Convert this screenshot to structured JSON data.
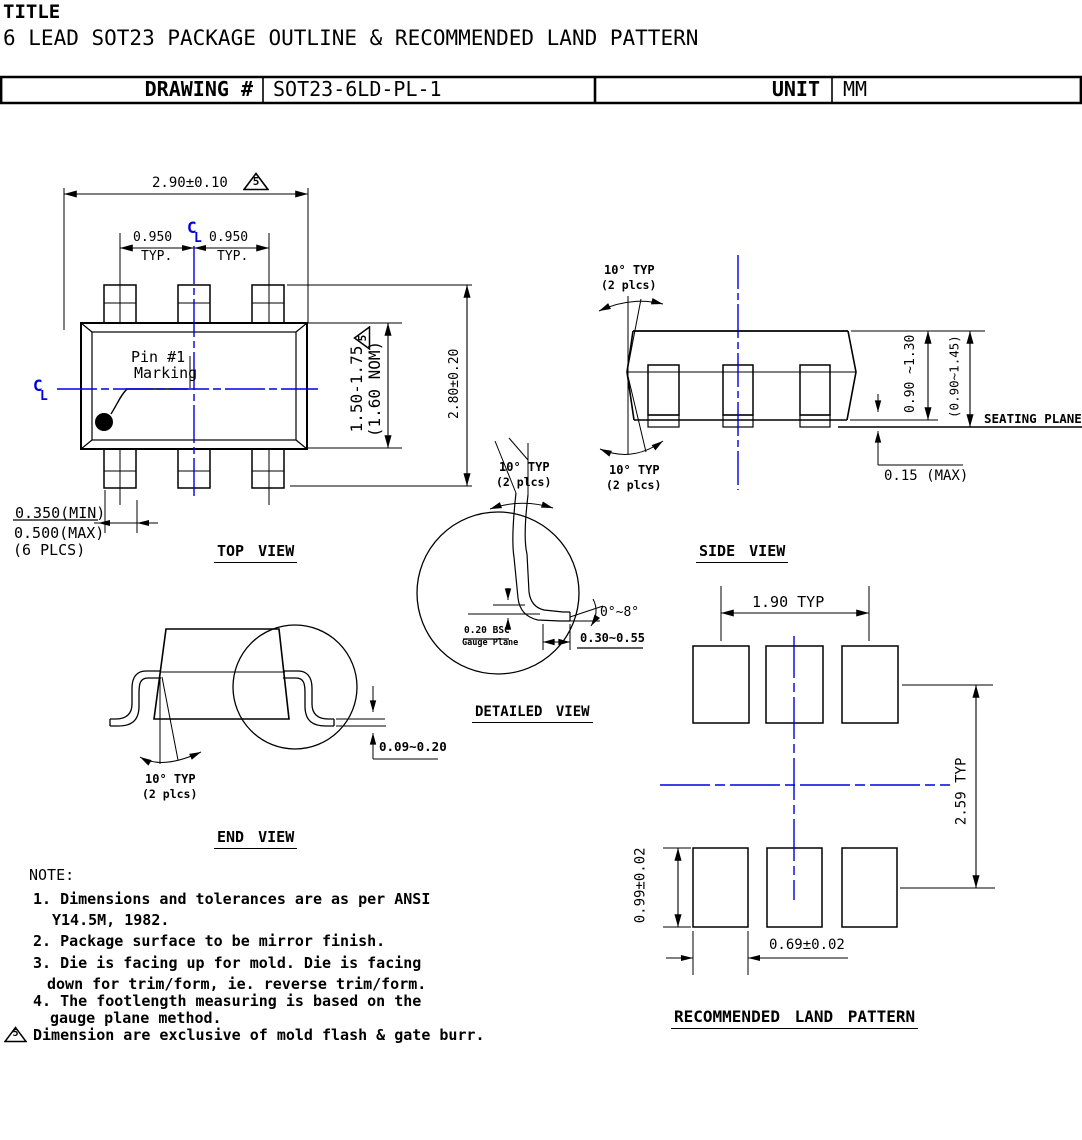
{
  "title_block": {
    "label": "TITLE",
    "subtitle": "6 LEAD SOT23 PACKAGE OUTLINE & RECOMMENDED LAND PATTERN",
    "drawing_label": "DRAWING #",
    "drawing_number": "SOT23-6LD-PL-1",
    "unit_label": "UNIT",
    "unit_value": "MM"
  },
  "colors": {
    "ink": "#000000",
    "centerline": "#0000e0"
  },
  "top_view": {
    "caption": "TOP VIEW",
    "width_dim": "2.90±0.10",
    "pitch_left": "0.950",
    "pitch_right": "0.950",
    "typ_left": "TYP.",
    "typ_right": "TYP.",
    "pin1_line1": "Pin #1",
    "pin1_line2": "Marking",
    "body_range": "1.50-1.75",
    "body_nom": "(1.60 NOM)",
    "overall_dim": "2.80±0.20",
    "lead_w_min": "0.350(MIN)",
    "lead_w_max": "0.500(MAX)",
    "lead_w_plcs": "(6 PLCS)"
  },
  "side_view": {
    "caption": "SIDE VIEW",
    "angle_top": "10° TYP",
    "angle_top_plcs": "(2 plcs)",
    "angle_bottom": "10° TYP",
    "angle_bottom_plcs": "(2 plcs)",
    "body_height": "0.90 ~1.30",
    "total_height": "(0.90~1.45)",
    "seating_plane": "SEATING PLANE",
    "standoff": "0.15 (MAX)"
  },
  "detailed_view": {
    "caption": "DETAILED VIEW",
    "angle": "10° TYP",
    "angle_plcs": "(2 plcs)",
    "lead_angle": "0°~8°",
    "gauge_dim": "0.20 BSC",
    "gauge_label": "Gauge Plane",
    "foot_length": "0.30~0.55"
  },
  "end_view": {
    "caption": "END VIEW",
    "angle": "10° TYP",
    "angle_plcs": "(2 plcs)",
    "lead_thickness": "0.09~0.20"
  },
  "land_pattern": {
    "caption": "RECOMMENDED LAND PATTERN",
    "pitch": "1.90 TYP",
    "row_span": "2.59 TYP",
    "pad_height": "0.99±0.02",
    "pad_width": "0.69±0.02"
  },
  "notes": {
    "heading": "NOTE:",
    "lines": [
      "1. Dimensions and tolerances are as per ANSI",
      "Y14.5M, 1982.",
      "2. Package surface to be mirror finish.",
      "3. Die is facing up for mold. Die is facing",
      "down for trim/form, ie. reverse trim/form.",
      "4. The footlength measuring is based on the",
      "gauge plane method.",
      "Dimension are exclusive of mold flash & gate burr."
    ]
  },
  "symbols": {
    "note_flag": "5",
    "centerline_c": "C",
    "centerline_l": "L"
  }
}
